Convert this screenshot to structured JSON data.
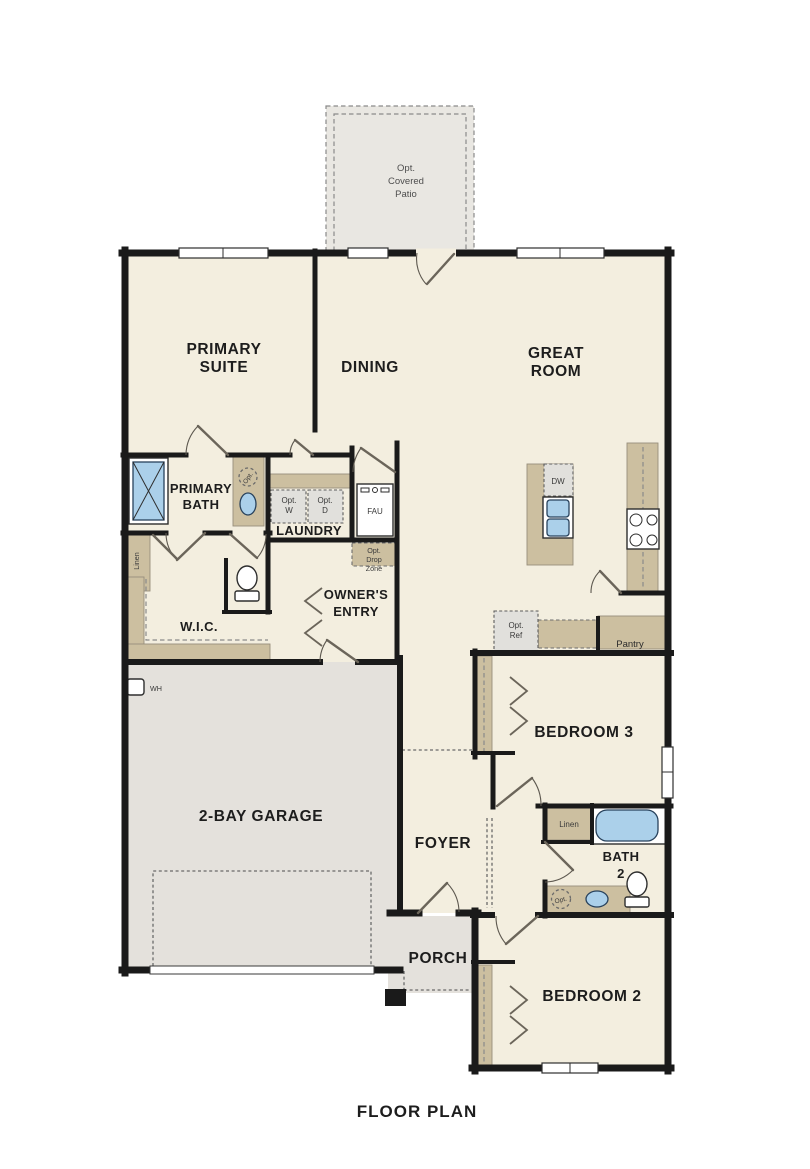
{
  "caption": "FLOOR PLAN",
  "labels": {
    "patio_l1": "Opt.",
    "patio_l2": "Covered",
    "patio_l3": "Patio",
    "primary_suite_l1": "PRIMARY",
    "primary_suite_l2": "SUITE",
    "dining": "DINING",
    "great_room_l1": "GREAT",
    "great_room_l2": "ROOM",
    "primary_bath_l1": "PRIMARY",
    "primary_bath_l2": "BATH",
    "laundry": "LAUNDRY",
    "owners_entry_l1": "OWNER'S",
    "owners_entry_l2": "ENTRY",
    "wic": "W.I.C.",
    "garage": "2-BAY GARAGE",
    "foyer": "FOYER",
    "bedroom3": "BEDROOM 3",
    "bedroom2": "BEDROOM 2",
    "bath2_l1": "BATH",
    "bath2_l2": "2",
    "porch": "PORCH",
    "pantry": "Pantry"
  },
  "annotations": {
    "linen_primary": "Linen",
    "linen_bath2": "Linen",
    "opt_w_l1": "Opt.",
    "opt_w_l2": "W",
    "opt_d_l1": "Opt.",
    "opt_d_l2": "D",
    "fau": "FAU",
    "dropzone_l1": "Opt.",
    "dropzone_l2": "Drop",
    "dropzone_l3": "Zone",
    "wh": "WH",
    "dw": "DW",
    "opt_ref_l1": "Opt.",
    "opt_ref_l2": "Ref",
    "opt_sink_primary": "Opt.",
    "opt_sink_bath2": "Opt."
  },
  "colors": {
    "wall": "#1a1a1a",
    "floor_cream": "#f3eedf",
    "garage_gray": "#e4e1dc",
    "patio_gray": "#e9e7e2",
    "cabinet_tan": "#ccbfa0",
    "appliance_gray": "#e1e0dc",
    "fixture_blue": "#abd0ea",
    "text_dark": "#1d1d1d"
  }
}
